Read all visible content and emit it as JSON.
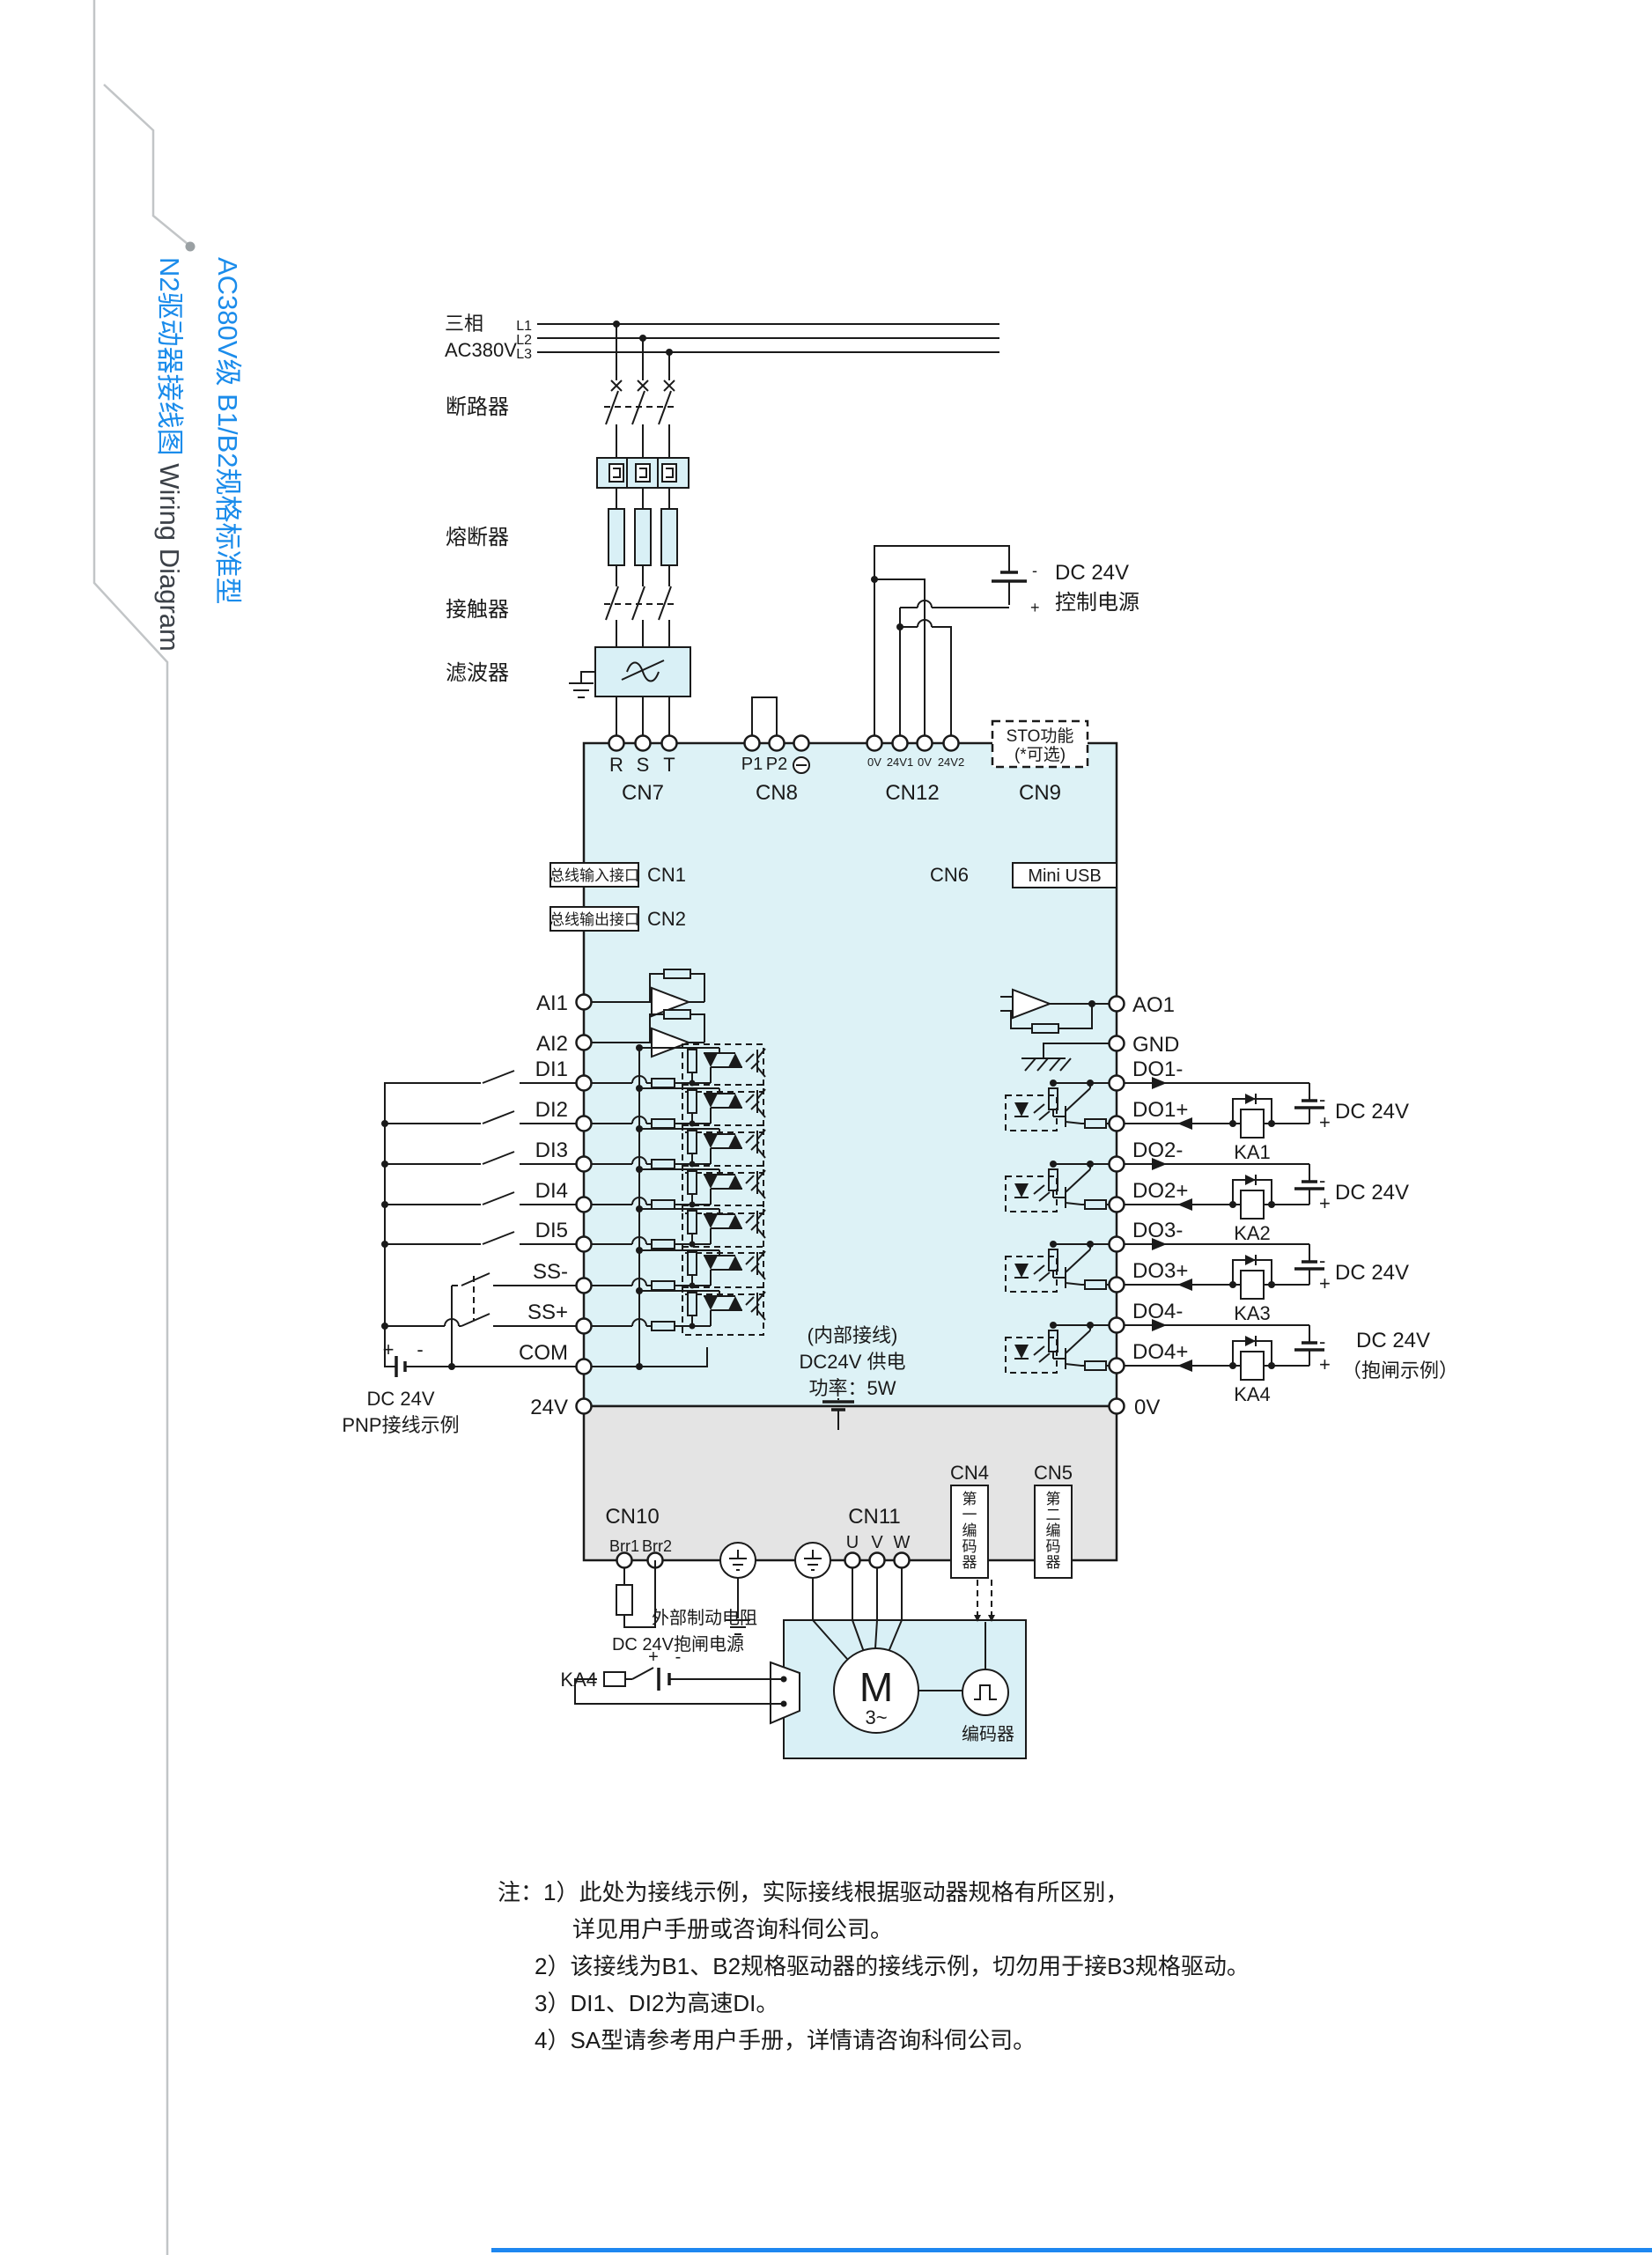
{
  "page": {
    "accent_blue": "#1b8ceb"
  },
  "sidebar_title": {
    "line1": "AC380V级 B1/B2规格标准型",
    "line2_cn": "N2驱动器接线图 ",
    "line2_en": "Wiring Diagram"
  },
  "supply": {
    "phase": "三相",
    "voltage": "AC380V",
    "l1": "L1",
    "l2": "L2",
    "l3": "L3"
  },
  "chain": {
    "breaker": "断路器",
    "fuse": "熔断器",
    "contactor": "接触器",
    "filter": "滤波器"
  },
  "control_power": {
    "name": "DC 24V",
    "name2": "控制电源",
    "plus": "+",
    "minus": "-"
  },
  "cn": {
    "cn7": "CN7",
    "cn8": "CN8",
    "cn12": "CN12",
    "cn9": "CN9",
    "cn1": "CN1",
    "cn2": "CN2",
    "cn6": "CN6",
    "cn10": "CN10",
    "cn11": "CN11",
    "cn4": "CN4",
    "cn5": "CN5"
  },
  "ports": {
    "bus_in": "总线输入接口",
    "bus_out": "总线输出接口",
    "mini_usb": "Mini USB",
    "sto1": "STO功能",
    "sto2": "(*可选)",
    "enc1": "第一编码器",
    "enc2": "第二编码器"
  },
  "top_terminals": {
    "r": "R",
    "s": "S",
    "t": "T",
    "p1": "P1",
    "p2": "P2",
    "v0a": "0V",
    "v24a": "24V1",
    "v0b": "0V",
    "v24b": "24V2"
  },
  "left_terminals": [
    "AI1",
    "AI2",
    "DI1",
    "DI2",
    "DI3",
    "DI4",
    "DI5",
    "SS-",
    "SS+",
    "COM",
    "24V"
  ],
  "right_terminals": [
    "AO1",
    "GND",
    "DO1-",
    "DO1+",
    "DO2-",
    "DO2+",
    "DO3-",
    "DO3+",
    "DO4-",
    "DO4+",
    "0V"
  ],
  "bottom_terminals": {
    "brr1": "Brr1",
    "brr2": "Brr2",
    "u": "U",
    "v": "V",
    "w": "W"
  },
  "pnp_source": {
    "line1": "DC 24V",
    "line2": "PNP接线示例",
    "plus": "+",
    "minus": "-"
  },
  "internal_supply": {
    "line1": "(内部接线)",
    "line2": "DC24V 供电",
    "line3": "功率：5W"
  },
  "relay_outputs": {
    "ka1": "KA1",
    "ka2": "KA2",
    "ka3": "KA3",
    "ka4": "KA4",
    "dc24v": "DC 24V",
    "brake_example": "（抱闸示例）",
    "plus": "+",
    "minus": "-"
  },
  "brake_circuit": {
    "resistor_label": "外部制动电阻",
    "ka4": "KA4",
    "power": "DC 24V抱闸电源",
    "plus": "+",
    "minus": "-"
  },
  "motor": {
    "m": "M",
    "phases": "3~",
    "encoder": "编码器"
  },
  "notes": [
    "注：1）此处为接线示例，实际接线根据驱动器规格有所区别，",
    "详见用户手册或咨询科伺公司。",
    "2）该接线为B1、B2规格驱动器的接线示例，切勿用于接B3规格驱动。",
    "3）DI1、DI2为高速DI。",
    "4）SA型请参考用户手册，详情请咨询科伺公司。"
  ]
}
